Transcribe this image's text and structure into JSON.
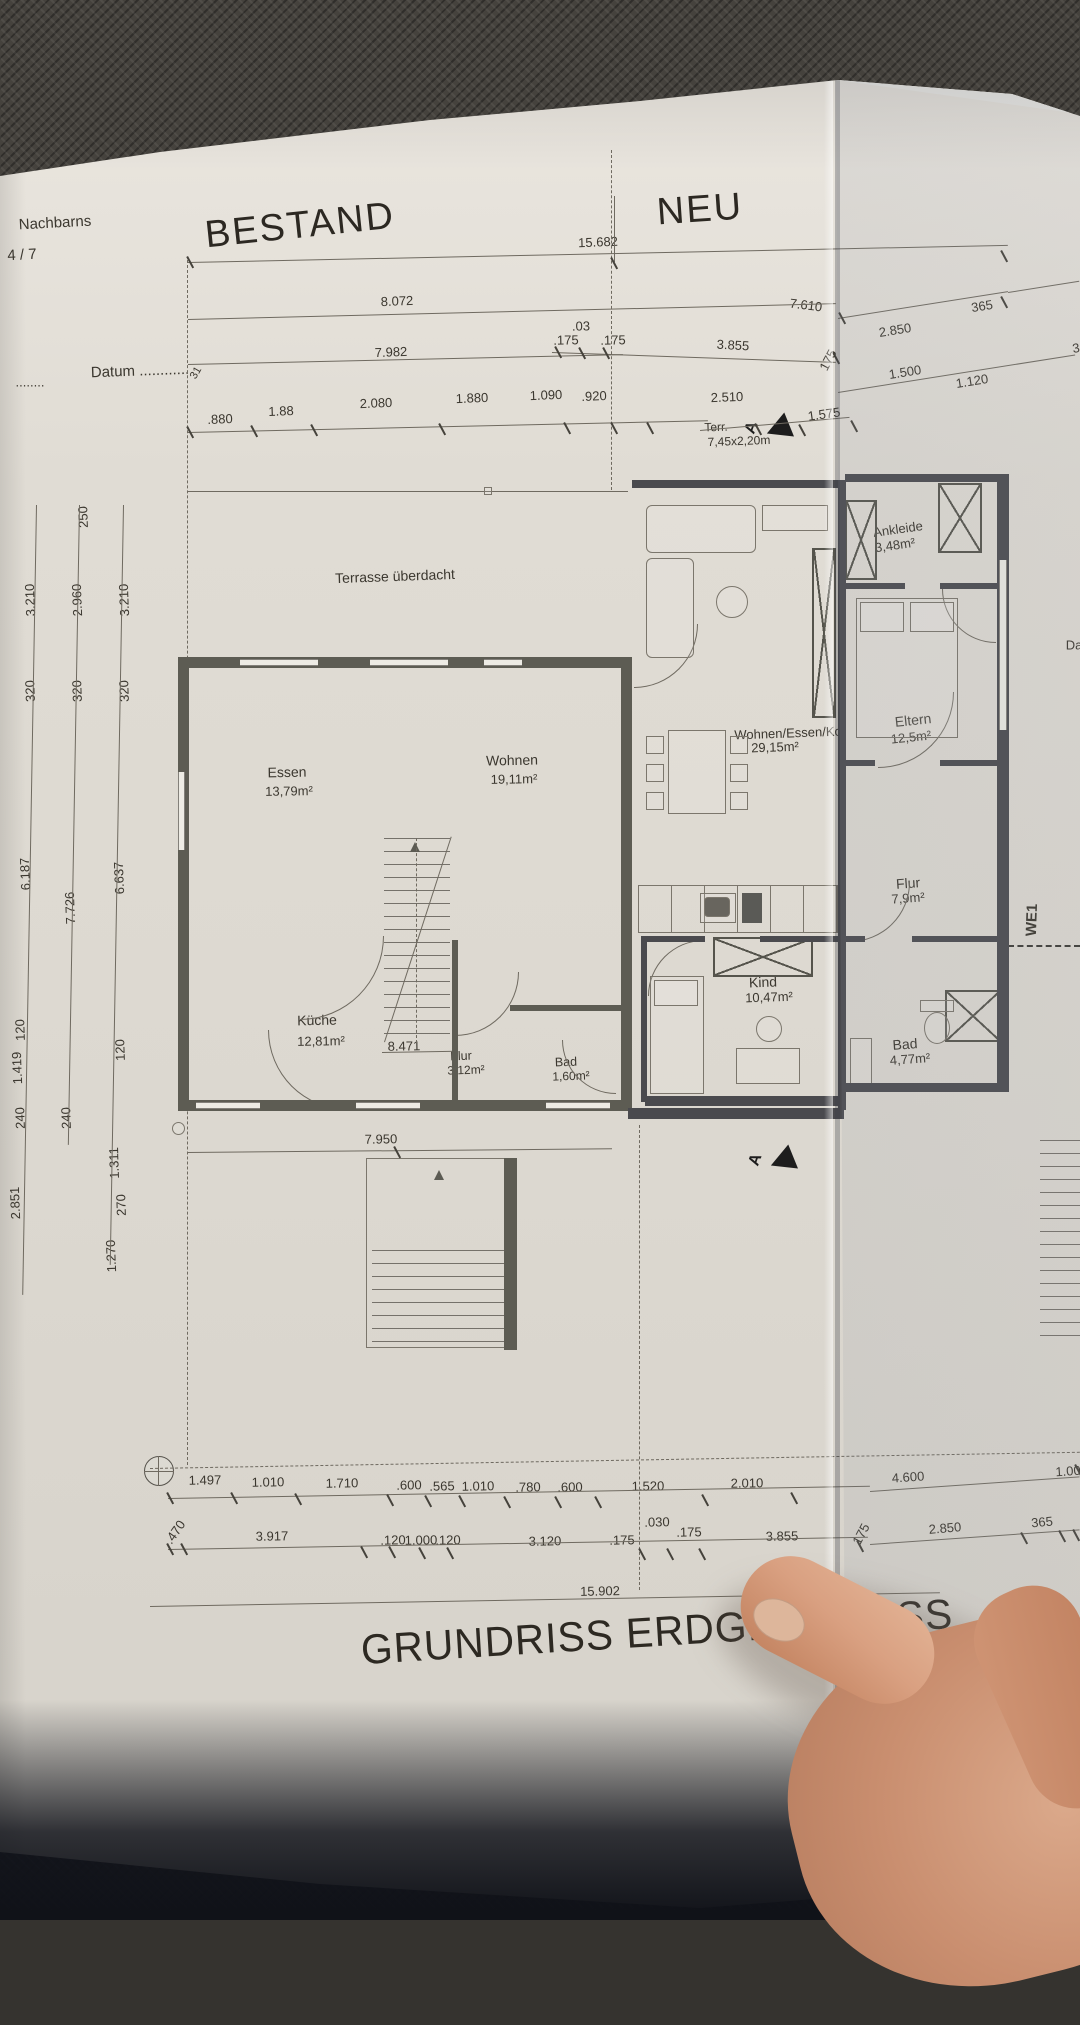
{
  "header": {
    "bestand": "BESTAND",
    "neu": "NEU",
    "nachbarns": "Nachbarns",
    "flurstueck": "4 / 7",
    "datum": "Datum ............",
    "dots_left": "........"
  },
  "title": {
    "text": "GRUNDRISS ERDGESCHOSS"
  },
  "terrace_note": {
    "line1": "Terr.",
    "line2": "7,45x2,20m"
  },
  "markers": {
    "section": "A",
    "we1": "WE1",
    "cut_right": "Da"
  },
  "rooms": {
    "terrasse": {
      "name": "Terrasse überdacht"
    },
    "essen": {
      "name": "Essen",
      "area": "13,79m²"
    },
    "wohnen": {
      "name": "Wohnen",
      "area": "19,11m²"
    },
    "kueche": {
      "name": "Küche",
      "area": "12,81m²"
    },
    "flur_alt": {
      "name": "Flur",
      "area": "3,12m²"
    },
    "bad_alt": {
      "name": "Bad",
      "area": "1,60m²"
    },
    "wek": {
      "name": "Wohnen/Essen/Ko",
      "area": "29,15m²"
    },
    "kind": {
      "name": "Kind",
      "area": "10,47m²"
    },
    "ankleide": {
      "name": "Ankleide",
      "area": "3,48m²"
    },
    "eltern": {
      "name": "Eltern",
      "area": "12,5m²"
    },
    "flur_neu": {
      "name": "Flur",
      "area": "7,9m²"
    },
    "bad_neu": {
      "name": "Bad",
      "area": "4,77m²"
    }
  },
  "dims": {
    "top": {
      "total": "15.682",
      "r1a": "8.072",
      "r1b": "7.610",
      "r2a": ".03",
      "r2b": ".175",
      "r2c": ".175",
      "r2d": "3.855",
      "r2e": "175",
      "r2f": "2.850",
      "r2g": "365",
      "r2h": "3",
      "r3a": "7.982",
      "r3b": "1.500",
      "r3c": "1.120",
      "small31": "31",
      "r4": [
        ".880",
        "1.88",
        "2.080",
        "1.880",
        "1.090",
        ".920",
        "2.510",
        "1.575"
      ]
    },
    "left": {
      "c1": [
        "3.210",
        "320",
        "6.187",
        "120",
        "1.419",
        "240",
        "2.851"
      ],
      "c2": [
        "250",
        "2.960",
        "320",
        "7.726",
        "240"
      ],
      "c3": [
        "3.210",
        "320",
        "6.637",
        "120",
        "1.311",
        "270",
        "1.270"
      ]
    },
    "inner": {
      "w1": "7.950",
      "w2": "8.471"
    },
    "bottom": {
      "r1": [
        "1.497",
        "1.010",
        "1.710",
        ".600",
        ".565",
        "1.010",
        ".780",
        ".600",
        "1.520",
        "2.010",
        "4.600",
        "1.00"
      ],
      "r2": [
        ".470",
        "3.917",
        ".120",
        "1.000",
        ".120",
        "3.120",
        ".175",
        ".030",
        ".175",
        "3.855",
        "175",
        "2.850",
        "365"
      ],
      "total": "15.902"
    }
  }
}
